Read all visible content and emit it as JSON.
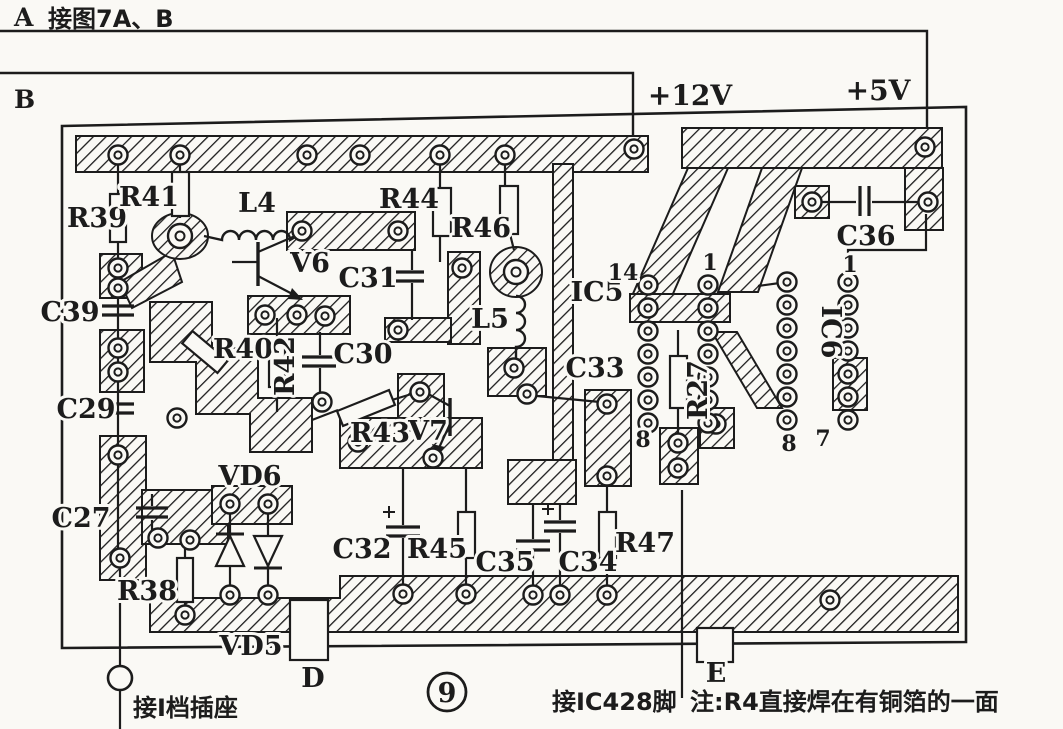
{
  "colors": {
    "paper": "#faf9f5",
    "ink": "#1c1c1c"
  },
  "figure": {
    "number": "9",
    "wire_a_label": "A",
    "wire_a_note": "接图7A、B",
    "wire_b_label": "B",
    "rail_12v": "+12V",
    "rail_5v": "+5V",
    "components": {
      "R39": "R39",
      "R41": "R41",
      "L4": "L4",
      "V6": "V6",
      "C31": "C31",
      "R44": "R44",
      "R46": "R46",
      "L5": "L5",
      "C36": "C36",
      "IC5": "IC5",
      "IC6": "IC6",
      "C39": "C39",
      "R40": "R40",
      "R42": "R42",
      "C30": "C30",
      "C33": "C33",
      "R27": "R27",
      "C29": "C29",
      "R43": "R43",
      "V7": "V7",
      "C27": "C27",
      "VD6": "VD6",
      "C32": "C32",
      "R45": "R45",
      "C35": "C35",
      "C34": "C34",
      "R47": "R47",
      "R38": "R38",
      "VD5": "VD5"
    },
    "ic_pins": {
      "ic5_top_left": "14",
      "ic5_top_right": "1",
      "ic5_bottom_left": "8",
      "ic6_top_right": "1",
      "ic6_bottom_left": "8",
      "ic6_bottom_right": "7"
    },
    "test_points": {
      "d": "D",
      "e": "E"
    },
    "annotations": {
      "socket": "接I档插座",
      "ic428": "接IC428脚",
      "solder_note": "注:R4直接焊在有铜箔的一面"
    }
  }
}
